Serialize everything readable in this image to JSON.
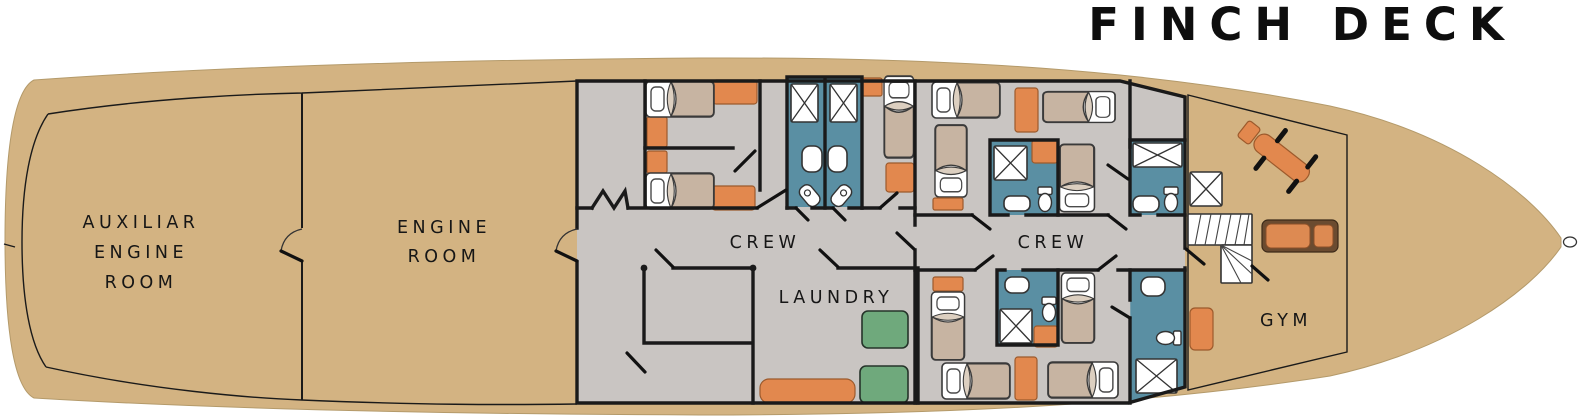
{
  "title": "FINCH DECK",
  "rooms": {
    "aux_engine_room": {
      "label_lines": [
        "AUXILIAR",
        "ENGINE",
        "ROOM"
      ]
    },
    "engine_room": {
      "label_lines": [
        "ENGINE",
        "ROOM"
      ]
    },
    "crew_port": {
      "label": "CREW"
    },
    "crew_starboard": {
      "label": "CREW"
    },
    "laundry": {
      "label": "LAUNDRY"
    },
    "gym": {
      "label": "GYM"
    }
  },
  "colors": {
    "hull_tan": "#d3b382",
    "interior_gray": "#c9c5c2",
    "bathroom_teal": "#5a8fa3",
    "furniture_orange": "#e2884e",
    "washer_green": "#6fa97c",
    "wall_black": "#1a1a1a",
    "blanket_tan": "#c7b4a2",
    "treadmill_brown": "#6b4b30",
    "fixture_white": "#ffffff"
  },
  "icons": [
    "bed-icon",
    "shower-icon",
    "toilet-icon",
    "sink-icon",
    "pedestal-sink-icon",
    "washer-icon",
    "dresser-icon",
    "nightstand-icon",
    "stairs-icon",
    "treadmill-icon",
    "bench-press-icon",
    "mat-icon",
    "door-icon",
    "bow-tip-fitting"
  ]
}
